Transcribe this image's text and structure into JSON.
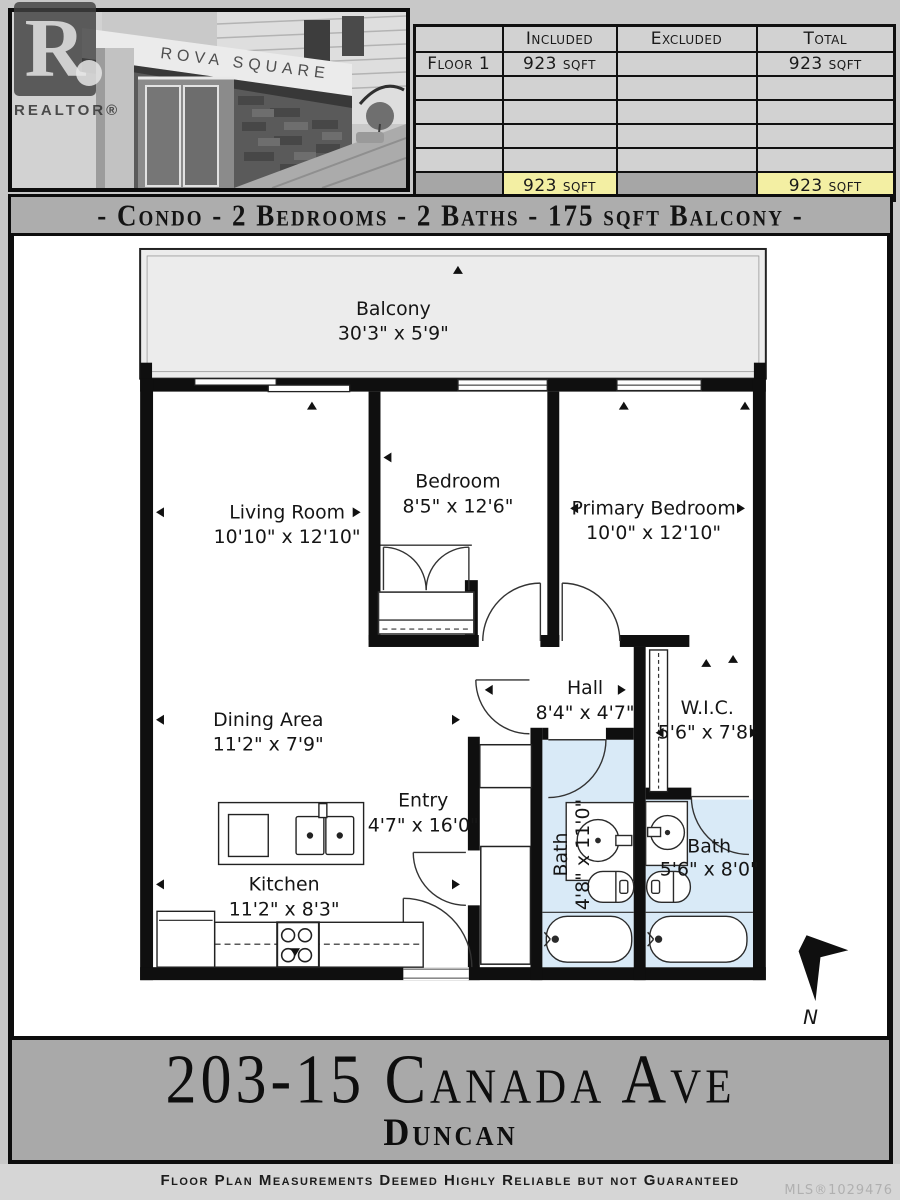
{
  "photo": {
    "sign_text": "ROVA SQUARE",
    "watermark_r": "R",
    "watermark_label": "REALTOR®"
  },
  "area_table": {
    "headers": [
      "",
      "Included",
      "Excluded",
      "Total"
    ],
    "rows": [
      [
        "Floor 1",
        "923 sqft",
        "",
        "923 sqft"
      ],
      [
        "",
        "",
        "",
        ""
      ],
      [
        "",
        "",
        "",
        ""
      ],
      [
        "",
        "",
        "",
        ""
      ],
      [
        "",
        "",
        "",
        ""
      ]
    ],
    "totals": [
      "",
      "923 sqft",
      "",
      "923 sqft"
    ],
    "highlight_color": "#f3efa3"
  },
  "summary_banner": "- Condo - 2 Bedrooms - 2 Baths - 175 sqft Balcony -",
  "plan": {
    "rooms": {
      "balcony": {
        "name": "Balcony",
        "dims": "30'3\" x 5'9\""
      },
      "living": {
        "name": "Living Room",
        "dims": "10'10\" x 12'10\""
      },
      "bedroom": {
        "name": "Bedroom",
        "dims": "8'5\" x 12'6\""
      },
      "primary": {
        "name": "Primary Bedroom",
        "dims": "10'0\" x 12'10\""
      },
      "dining": {
        "name": "Dining Area",
        "dims": "11'2\" x 7'9\""
      },
      "hall": {
        "name": "Hall",
        "dims": "8'4\" x 4'7\""
      },
      "wic": {
        "name": "W.I.C.",
        "dims": "5'6\" x 7'8\""
      },
      "entry": {
        "name": "Entry",
        "dims": "4'7\" x 16'0\""
      },
      "kitchen": {
        "name": "Kitchen",
        "dims": "11'2\" x 8'3\""
      },
      "bath1": {
        "name": "Bath",
        "dims": "4'8\" x 11'0\""
      },
      "bath2": {
        "name": "Bath",
        "dims": "5'6\" x 8'0\""
      }
    },
    "north_label": "N",
    "bath_fill": "#d9eaf7",
    "balcony_fill": "#ececec"
  },
  "address": {
    "line1": "203-15 Canada Ave",
    "line2": "Duncan"
  },
  "footer": {
    "disclaimer": "Floor Plan Measurements Deemed Highly Reliable but not Guaranteed",
    "mls": "MLS®1029476"
  }
}
